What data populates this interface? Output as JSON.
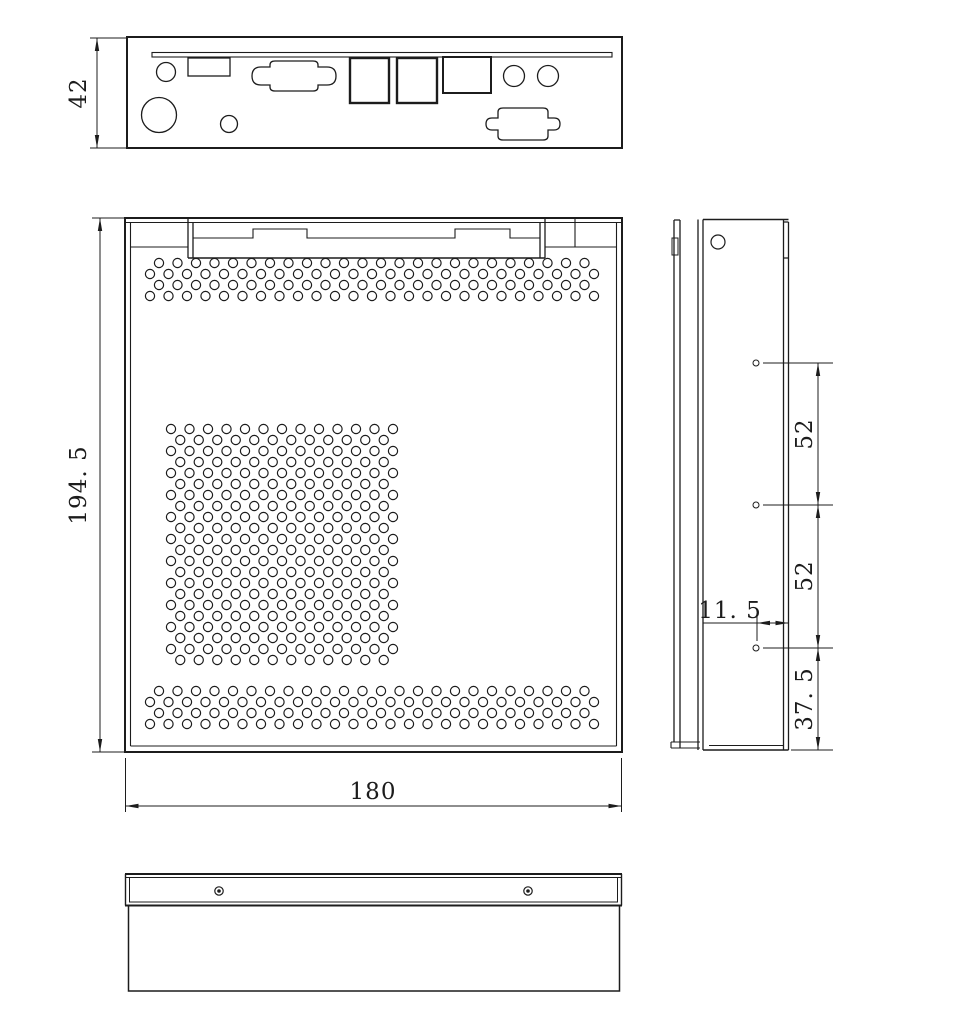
{
  "drawing": {
    "colors": {
      "line": "#1c1c1c",
      "background": "#ffffff"
    },
    "dimensions": {
      "rear_panel_height": "42",
      "cover_length": "194. 5",
      "cover_width": "180",
      "side_hole_pitch_upper": "52",
      "side_hole_pitch_lower": "52",
      "hole_to_edge": "11. 5",
      "hole_to_bottom": "37. 5"
    }
  }
}
